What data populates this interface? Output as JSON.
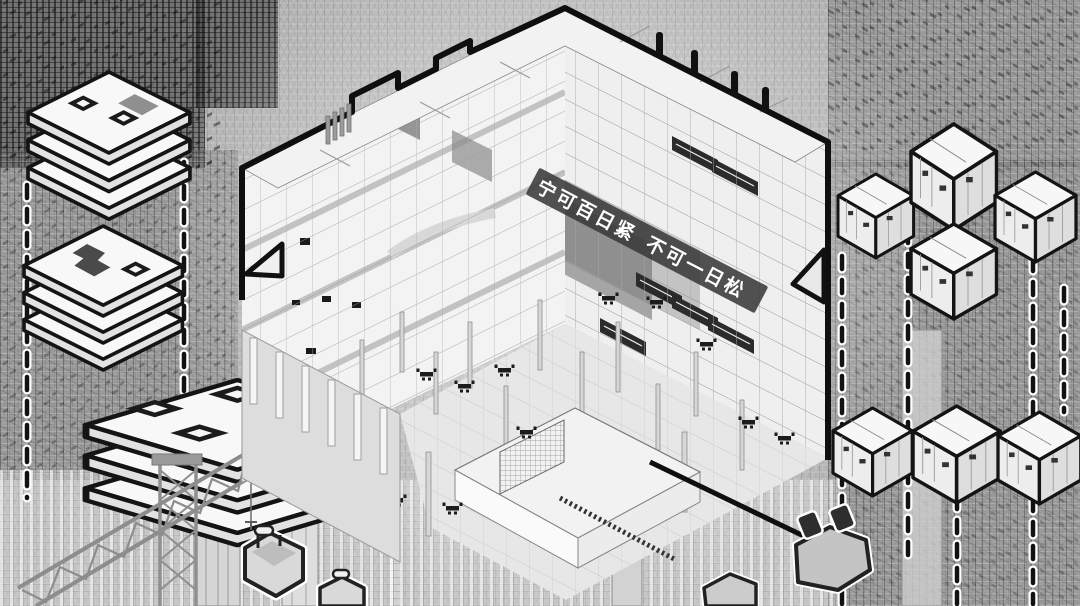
{
  "artwork": {
    "banner": {
      "phrase1": "宁可百日紧",
      "phrase2": "不可一日松"
    },
    "palette": {
      "background": "#b4b4b4",
      "ink": "#121212",
      "paper": "#f5f5f5",
      "banner_bg": "#3a3a3a",
      "banner_text": "#ffffff",
      "crane": "#8d8d8d",
      "shadow": "#6a6a6a"
    },
    "elements": {
      "central_building": "cutaway-tower",
      "left_modules": [
        "plate-stack-a",
        "plate-stack-b",
        "plate-stack-c"
      ],
      "right_modules": [
        "cube-a",
        "cube-b",
        "cube-c",
        "cube-d",
        "cube-e",
        "cube-f",
        "cube-g"
      ],
      "foreground": [
        "tower-crane",
        "lift-basket-a",
        "lift-basket-b",
        "platform-a",
        "platform-b"
      ],
      "connectors": "dashed-guides"
    }
  }
}
